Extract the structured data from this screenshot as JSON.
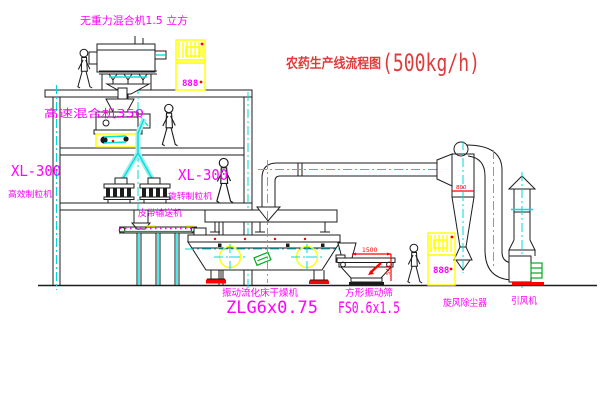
{
  "meta": {
    "width": 600,
    "height": 403,
    "background": "#ffffff"
  },
  "title": {
    "name": "农药生产线流程图",
    "capacity": "(500kg/h)"
  },
  "equipment_labels": {
    "gravity_mixer": "无重力混合机1.5 立方",
    "high_speed_mixer": "高速混合机350",
    "granulator_left_model": "XL-300",
    "granulator_left_name": "高效制粒机",
    "granulator_right_model": "XL-300",
    "granulator_right_name": "旋转制粒机",
    "belt_conveyor": "皮带输送机",
    "fluid_bed_dryer_name": "振动流化床干燥机",
    "fluid_bed_dryer_model": "ZLG6x0.75",
    "square_sieve_name": "方形振动筛",
    "square_sieve_model": "FS0.6x1.5",
    "cyclone_collector": "旋风除尘器",
    "induced_draft_fan": "引风机"
  },
  "dimensions": {
    "sieve_length": "1500",
    "sieve_height": "541",
    "cyclone_outlet": "800"
  },
  "control_cabinets": {
    "cabinet_top_display": "888",
    "cabinet_right_display": "888"
  },
  "colors": {
    "line": "#1c1c1c",
    "centerline_cyan": "#00d8d8",
    "label_magenta": "#ff00ff",
    "title_red": "#e03b3b",
    "dimension_red": "#ff0000",
    "cabinet_yellow": "#ffff00",
    "conveyor_green": "#00aa22"
  }
}
